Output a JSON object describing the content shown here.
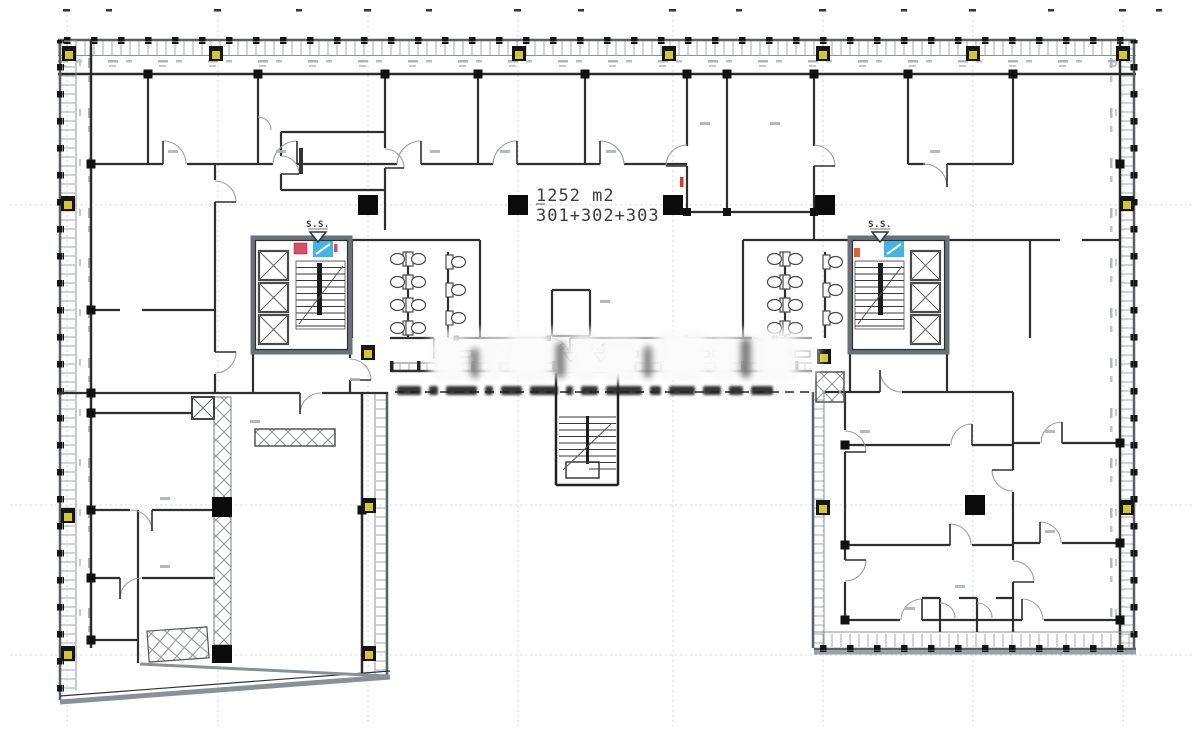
{
  "plan": {
    "area_label": "1252 m2",
    "unit_label": "301+302+303"
  },
  "markers": {
    "section": "S.S."
  },
  "colors": {
    "wall": "#2f2f2f",
    "facade_outer": "#5a5f63",
    "facade_gray": "#8a9196",
    "grid_line": "#cfd8df",
    "column_black": "#0b0b0b",
    "cabinet_yellow": "#cfc830",
    "icon_red": "#d6506b",
    "icon_blue": "#41b6e6",
    "red_mark": "#e03434"
  }
}
